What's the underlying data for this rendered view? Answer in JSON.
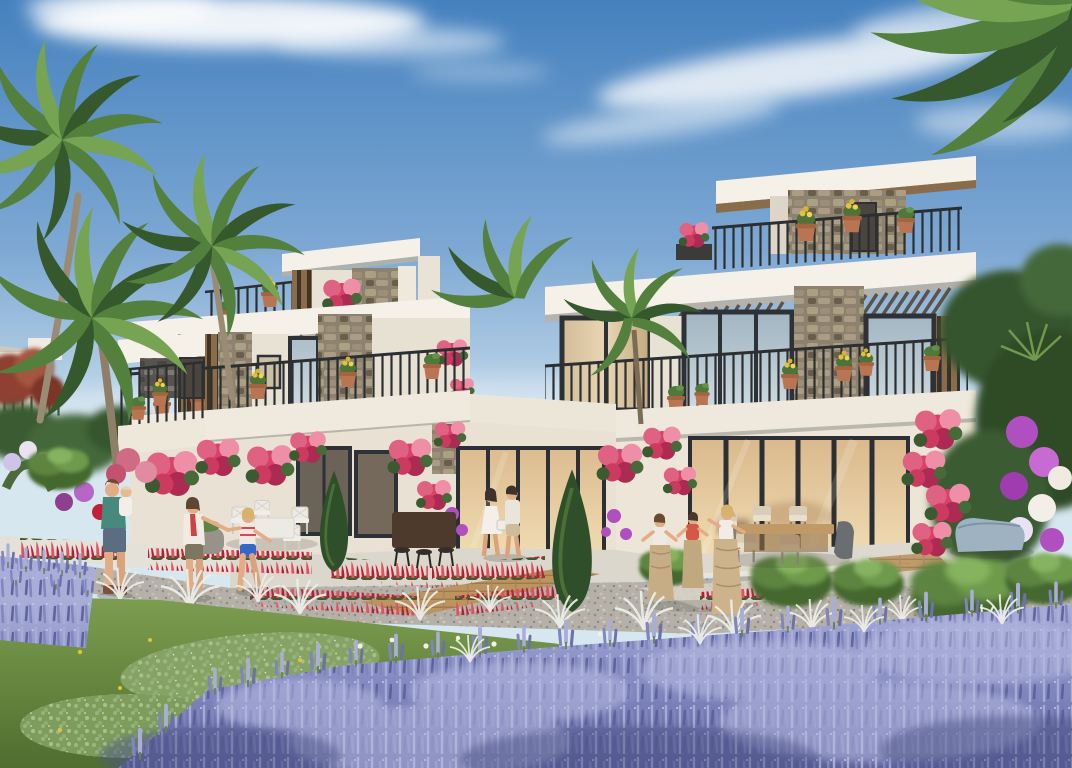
{
  "scene": {
    "type": "architectural-exterior-render",
    "setting": "modern two-storey townhouse villas with roof terraces, flowering gardens, sack-race lawn and lavender beds under a blue sky with wispy clouds",
    "palette": {
      "sky_top": "#4581be",
      "sky_mid": "#7fa9d4",
      "sky_low": "#a9c7e1",
      "sky_horizon": "#d6e7f0",
      "cloud": "#ffffff",
      "roof_white": "#f5f1e8",
      "wall_cream": "#e8e2d5",
      "wall_shadow": "#d7d0c2",
      "stone_base": "#8d8270",
      "stone_light": "#aca083",
      "stone_dark": "#695e4a",
      "stone_cool": "#57534d",
      "wood": "#8a6c4a",
      "wood_dark": "#54412e",
      "frame_dark": "#2e3236",
      "glass_warm_top": "#dab98c",
      "glass_warm_bottom": "#f1ddb4",
      "glass_cool_top": "#9fb3c0",
      "glass_cool_bottom": "#cfdbe1",
      "curtain": "#d3bc98",
      "railing": "#2c2f31",
      "terracotta": "#b97551",
      "bougainvillea": "#d84168",
      "bougainvillea_light": "#ef8fa7",
      "bougainvillea_deep": "#ad2a52",
      "red_flower": "#c2203a",
      "red_flower_light": "#e44f5e",
      "yellow_flower": "#e4c03c",
      "purple_flower": "#b04fc0",
      "white_flower": "#f3efe8",
      "lavender_dark": "#5c6198",
      "lavender_mid": "#7f85bd",
      "lavender_light": "#a9aed8",
      "grass_light": "#7d9e50",
      "grass_dark": "#4f6e2f",
      "clover": "#9db87f",
      "gravel": "#b5b1a9",
      "path": "#e4e1d8",
      "deck": "#bb9460",
      "palm_green": "#53803d",
      "palm_dark": "#35582c",
      "palm_light": "#76a452",
      "foliage_dark": "#2f4f2a",
      "skin": "#e2ad85"
    },
    "sky": {
      "clouds": "wispy white cloud band upper left, diagonal wisps upper right"
    },
    "buildings": {
      "left_wing": {
        "features": "balcony railing with terracotta pots, dark stone feature wall, mostly hidden by palms"
      },
      "middle_wing": {
        "features": "roof terrace box with wood and stone, terrace railing with pots, deep white fascia with pergola slats, stone columns, balcony railing with yellow-flower pots, ground floor windows and warm glass doors draped in pink bougainvillea"
      },
      "right_wing": {
        "features": "upper roof slab, roof terrace with stone wall and yellow flower pots, white fascia with wood pergola slats, curtained window, stone column, balcony railing with pots, warm-lit glass sliding doors, patio"
      }
    },
    "vegetation": {
      "palms": 5,
      "lavender": "large foreground field lower right plus small patch lower left",
      "bougainvillea": "pink climbing masses on walls and two tall columns at right",
      "red_flower_borders": "rows of red spikes along walkways",
      "lawn": "bottom-left lawn with clover patches and yellow dandelions",
      "white_grasses": "silver feathery tufts along gravel edges",
      "cypresses": 2,
      "round_bushes": 5,
      "maple": "russet red maple far left"
    },
    "people": [
      {
        "label": "man carrying toddler",
        "shirt": "#47897c",
        "shorts": "#5b6d80",
        "hair": "#6b4a33"
      },
      {
        "label": "toddler",
        "outfit": "#f3efe8",
        "hair": "#e6d3a8"
      },
      {
        "label": "woman with red scarf",
        "top": "#f2ebe4",
        "scarf": "#cd4444",
        "shorts": "#7b7760",
        "hair": "#5d4632"
      },
      {
        "label": "girl holding woman's hand",
        "top": "#f2e6e0",
        "shorts": "#3468c6",
        "hair": "#d7b26a"
      },
      {
        "label": "boy in sack race",
        "top": "#eeeae2",
        "sack": "#c7ad85",
        "hair": "#6b4a33"
      },
      {
        "label": "boy in red shirt in sack race",
        "top": "#d6564a",
        "sack": "#c2a87f",
        "hair": "#4a3a2c"
      },
      {
        "label": "girl jumping in sack race",
        "top": "#f1ede6",
        "sack": "#cdb38b",
        "hair": "#d7b26a"
      },
      {
        "label": "woman in white dress with bag",
        "dress": "#f4f0e9",
        "hair": "#3c332c"
      },
      {
        "label": "man walking beside woman",
        "shirt": "#eae5da",
        "shorts": "#cdbb9b",
        "hair": "#3c332c"
      }
    ],
    "furniture": {
      "white_dining_set": {
        "color": "#eceae3",
        "chairs": 4
      },
      "bar_counter": {
        "color": "#4e3a2c",
        "stools": 3
      },
      "patio_dining_set": {
        "table": "#c09a66",
        "chairs": 5,
        "cushions": "#e4dac4"
      },
      "daybed": {
        "color": "#9fb2c2"
      },
      "stone_planter": {
        "color": "#97928a"
      }
    }
  }
}
